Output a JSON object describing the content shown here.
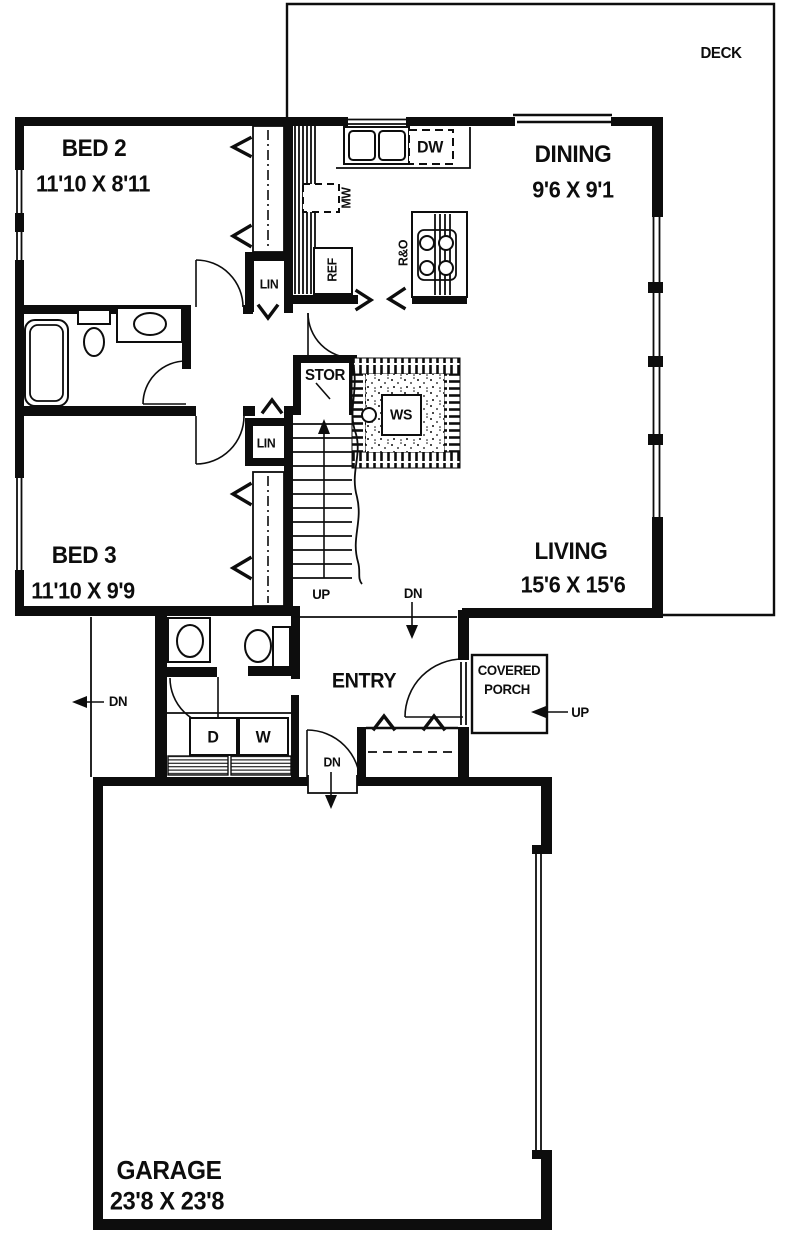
{
  "plan": {
    "deck": {
      "label": "DECK"
    },
    "bed2": {
      "label": "BED 2",
      "dims": "11'10 X 8'11"
    },
    "dining": {
      "label": "DINING",
      "dims": "9'6 X 9'1"
    },
    "living": {
      "label": "LIVING",
      "dims": "15'6 X 15'6"
    },
    "bed3": {
      "label": "BED 3",
      "dims": "11'10 X 9'9"
    },
    "entry": {
      "label": "ENTRY"
    },
    "porch": {
      "label_line1": "COVERED",
      "label_line2": "PORCH"
    },
    "garage": {
      "label": "GARAGE",
      "dims": "23'8 X 23'8"
    },
    "fixtures": {
      "dishwasher": "DW",
      "microwave": "MW",
      "refrigerator": "REF",
      "range_oven": "R&O",
      "storage": "STOR",
      "wood_stove": "WS",
      "linen_upper": "LIN",
      "linen_lower": "LIN",
      "dryer": "D",
      "washer": "W"
    },
    "annotations": {
      "up_stairs": "UP",
      "dn_hall": "DN",
      "dn_exterior": "DN",
      "dn_garage": "DN",
      "up_porch": "UP"
    }
  }
}
